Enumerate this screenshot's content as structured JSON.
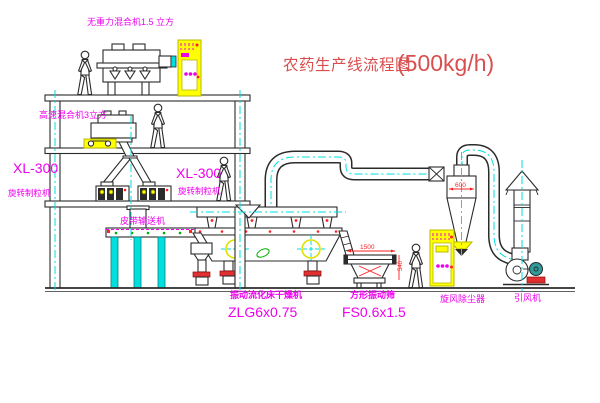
{
  "diagram": {
    "title": "农药生产线流程图",
    "capacity": "(500kg/h)"
  },
  "labels": {
    "gravity_mixer": "无重力混合机1.5 立方",
    "high_speed_mixer": "高速混合机3立方",
    "granulator_model_left": "XL-300",
    "granulator_left": "旋转制粒机",
    "granulator_model_right": "XL-300",
    "granulator_right": "旋转制粒机",
    "belt_conveyor": "皮带输送机",
    "fluid_bed_dryer": "振动流化床干燥机",
    "fluid_bed_dryer_model": "ZLG6x0.75",
    "square_vibrating_screen": "方形振动筛",
    "square_vibrating_screen_model": "FS0.6x1.5",
    "cyclone_dust_collector": "旋风除尘器",
    "induced_draft_fan": "引风机"
  },
  "dimensions": {
    "cyclone_diameter": "600",
    "screen_length": "1500",
    "screen_height": "540"
  },
  "colors": {
    "ink": "#2b2b2b",
    "magenta": "#ee00ee",
    "titleRed": "#d94f4f",
    "dimRed": "#ff2020",
    "cyan": "#00dede",
    "yellow": "#ffff00",
    "green": "#00b000",
    "teal": "#2f9a9a"
  }
}
